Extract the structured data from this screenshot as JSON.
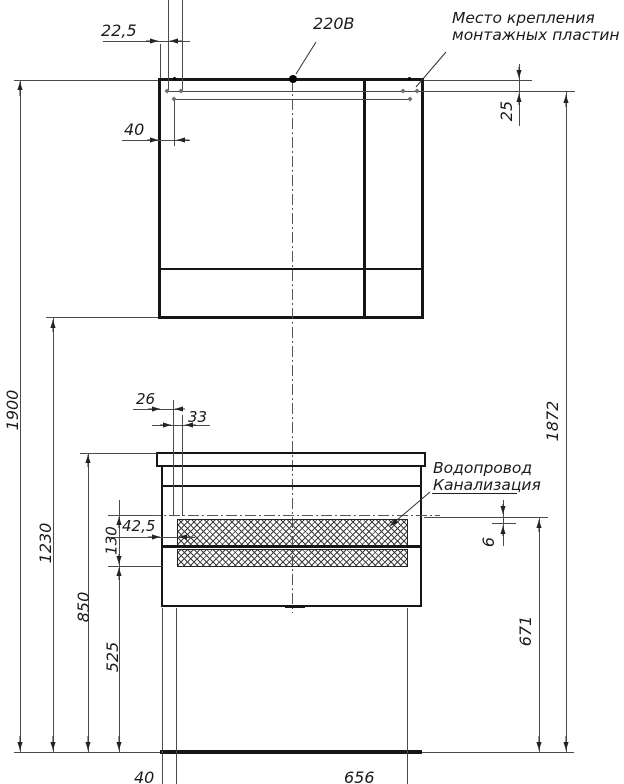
{
  "drawing": {
    "kind": "furniture installation drawing (mirror cabinet and vanity), front view",
    "colors": {
      "background": "#ffffff",
      "main_line": "#161616",
      "thin_line": "#4a4a4a"
    }
  },
  "labels": {
    "power": "220В",
    "mount_line1": "Место крепления",
    "mount_line2": "монтажных пластин",
    "water": "Водопровод",
    "sewer": "Канализация"
  },
  "dims": {
    "d22_5": "22,5",
    "d40_top": "40",
    "d25": "25",
    "d26": "26",
    "d33": "33",
    "d42_5": "42,5",
    "d130": "130",
    "d1900": "1900",
    "d1230": "1230",
    "d850": "850",
    "d525": "525",
    "d6": "6",
    "d671": "671",
    "d1872": "1872",
    "d40_bottom": "40",
    "d656": "656"
  }
}
